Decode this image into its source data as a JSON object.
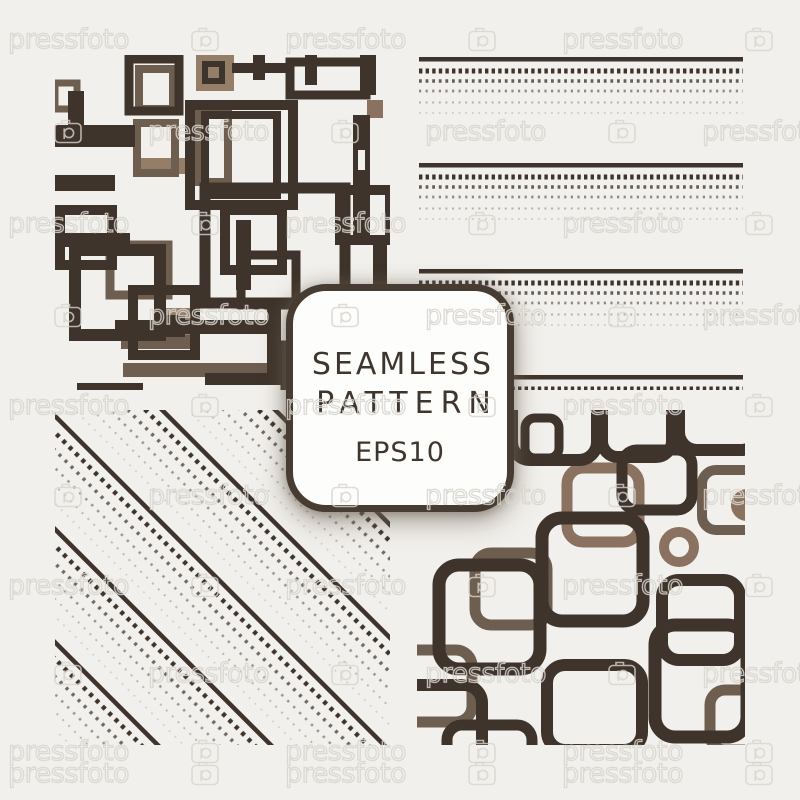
{
  "badge": {
    "title_line1": "SEAMLESS",
    "title_line2": "PATTERN",
    "subtitle": "EPS10"
  },
  "watermark": {
    "text": "pressfoto",
    "camera_icon": "pressfoto-camera-icon"
  },
  "colors": {
    "background": "#f2f0ec",
    "dark_brown": "#3e342b",
    "medium_brown": "#6d5e4f",
    "light_brown": "#947e68",
    "tan_brown": "#8a7160",
    "badge_background": "#fdfdfc",
    "badge_border": "#473c31",
    "badge_text": "#3e352d",
    "watermark_gray": "#d8d5ce"
  }
}
